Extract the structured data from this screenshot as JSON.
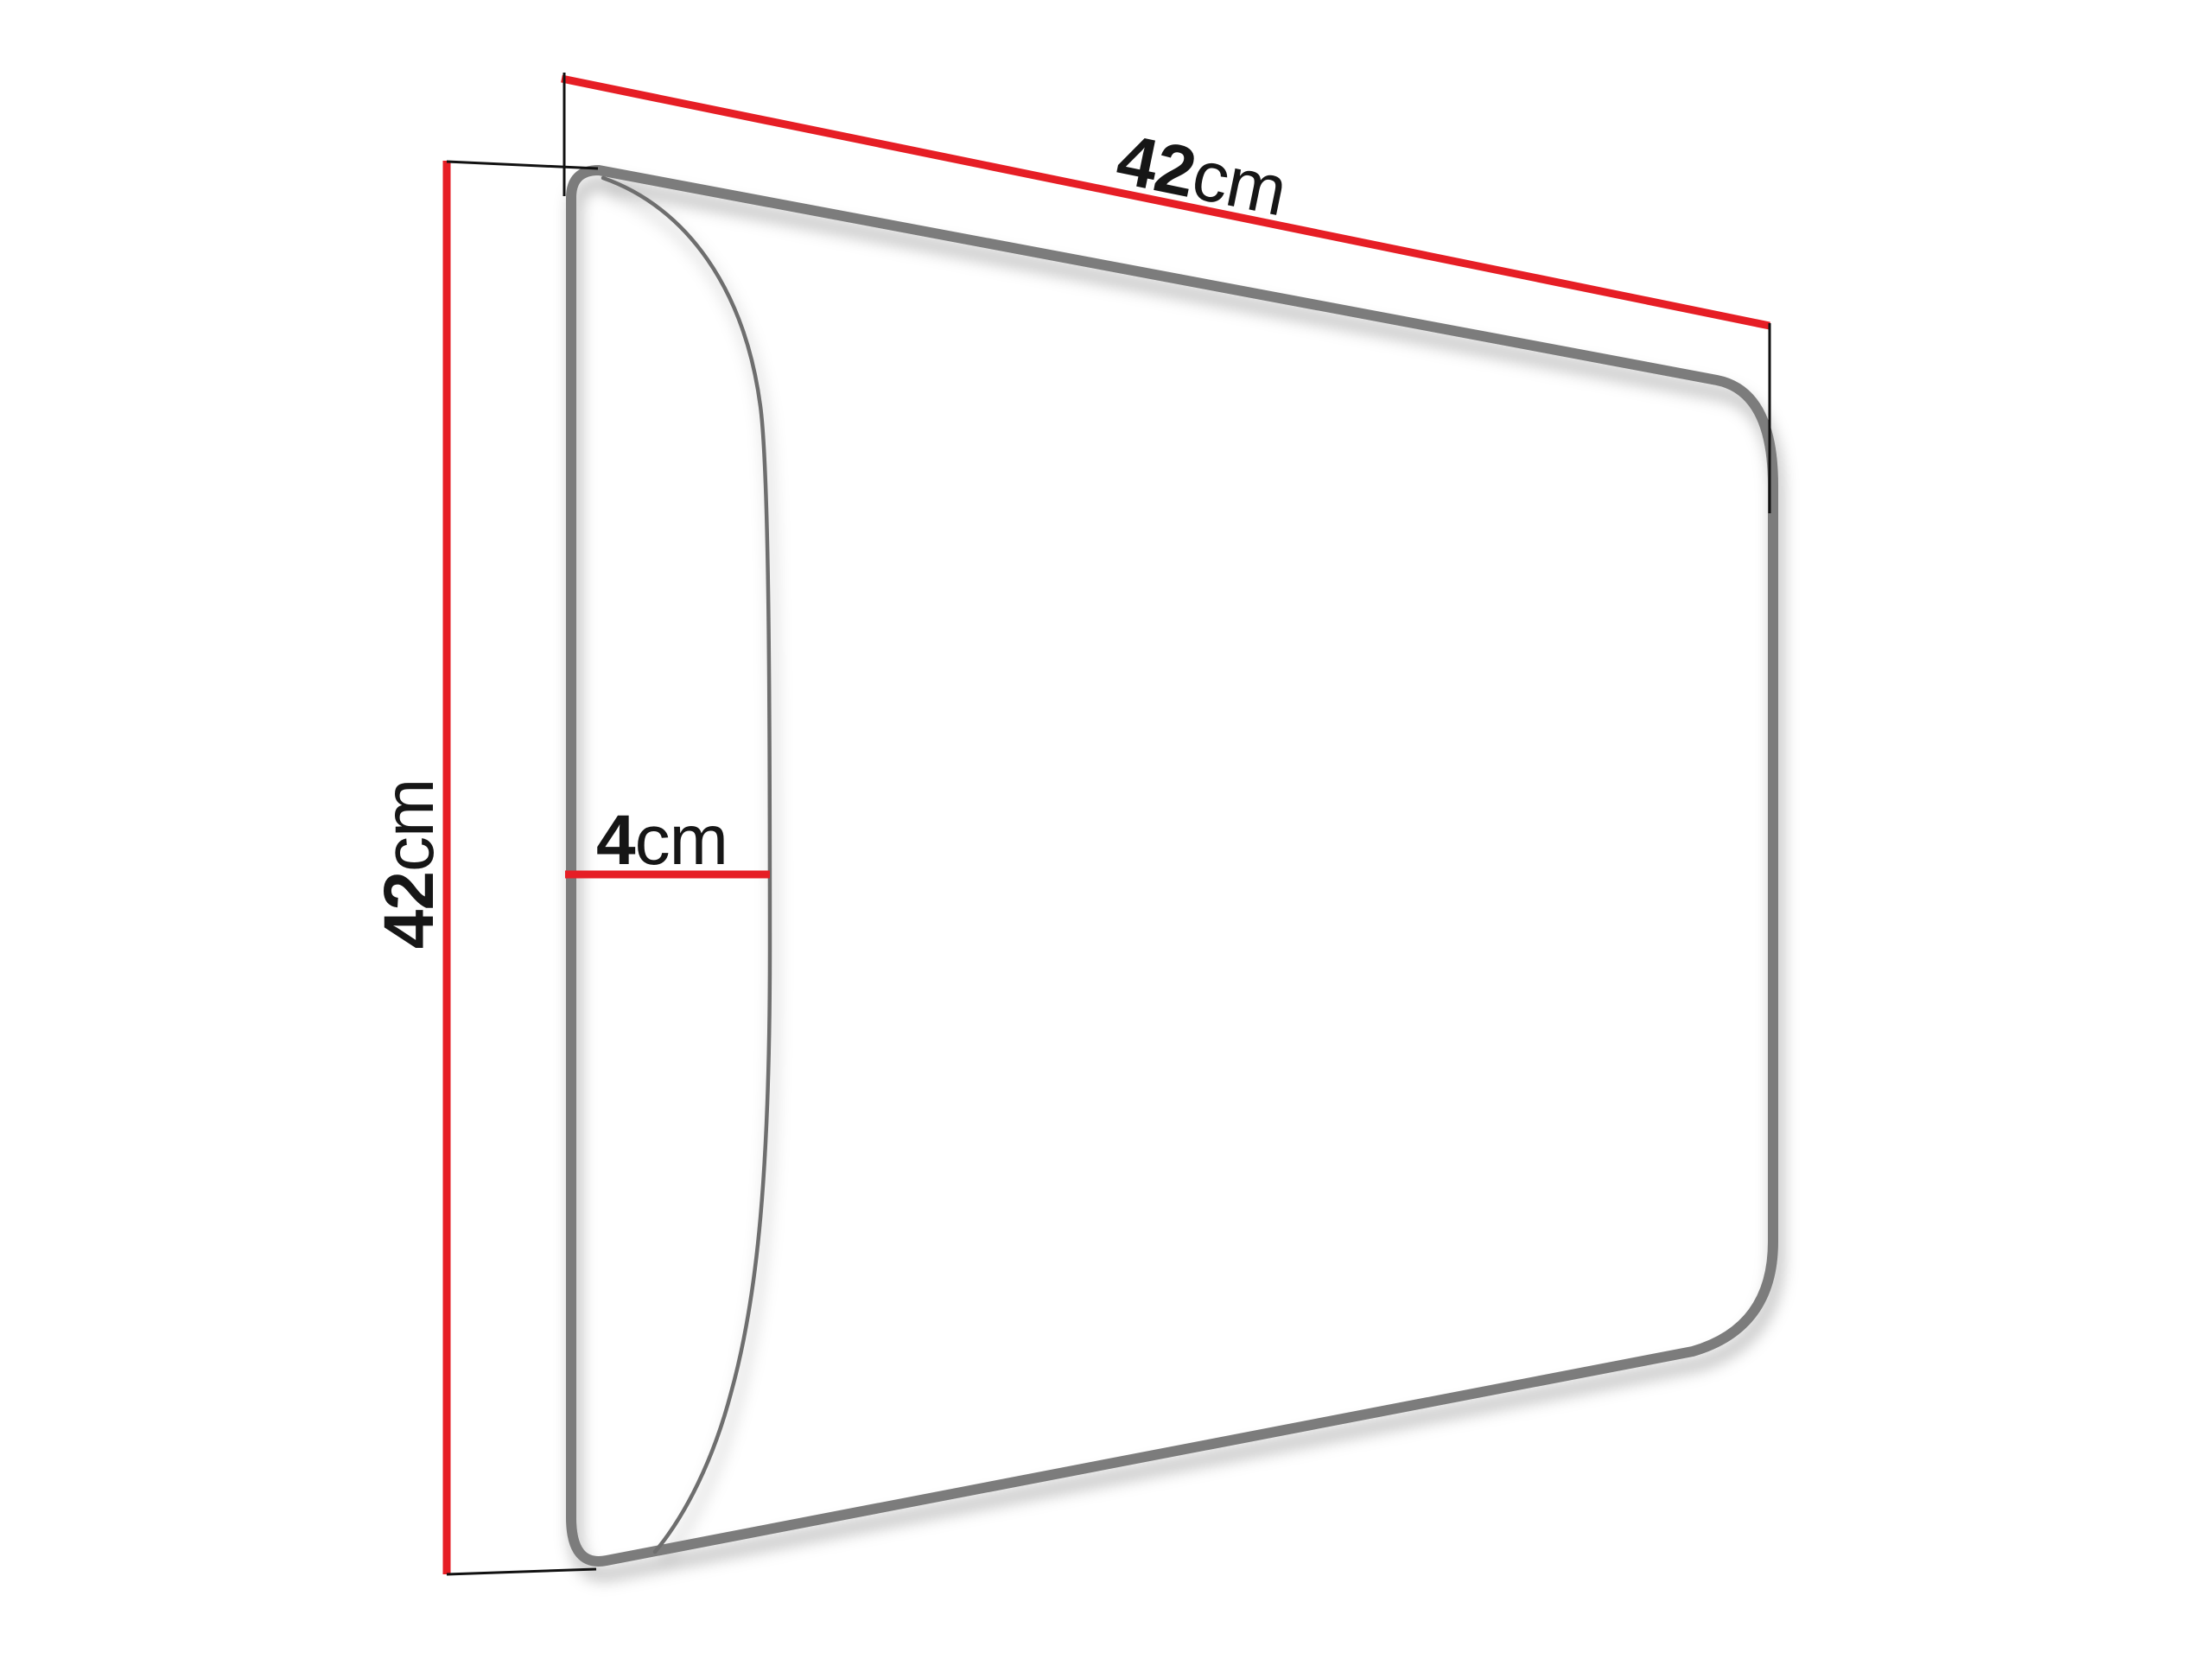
{
  "diagram": {
    "kind": "product-dimension-diagram",
    "subject": "upholstered-wall-panel-perspective-outline",
    "background_color": "#ffffff",
    "panel": {
      "outline_color": "#7b7b7b",
      "face_color": "#ffffff",
      "bulge_line_color": "#6e6e6e"
    },
    "dimension_color": "#e61e25",
    "extension_line_color": "#111111",
    "text_color": "#161616",
    "labels": {
      "width": {
        "value": "42",
        "unit": "cm"
      },
      "height": {
        "value": "42",
        "unit": "cm"
      },
      "depth": {
        "value": "4",
        "unit": "cm"
      }
    }
  }
}
